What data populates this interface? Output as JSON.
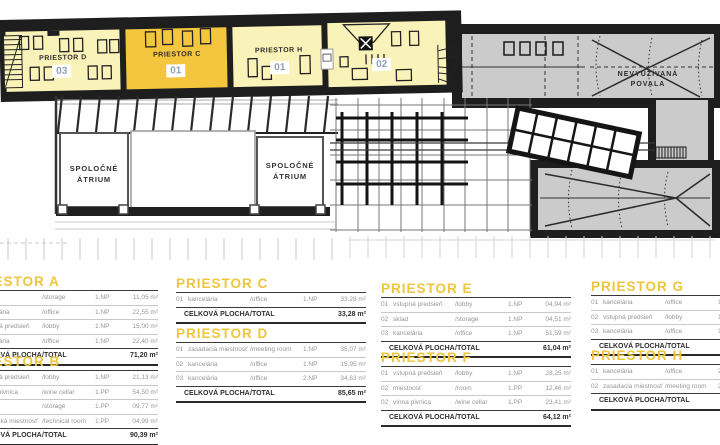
{
  "plan": {
    "rooms": [
      {
        "label": "PRIESTOR D",
        "badge": "03"
      },
      {
        "label": "PRIESTOR C",
        "badge": "01"
      },
      {
        "label": "PRIESTOR H",
        "badge": "01"
      },
      {
        "label": "",
        "badge": "02"
      }
    ],
    "attic": {
      "line1": "NEVYUŽÍVANÁ",
      "line2": "POVALA"
    },
    "atrium": {
      "line1": "SPOLOČNÉ",
      "line2": "ÁTRIUM"
    }
  },
  "colors": {
    "accent_gold": "#F3C63E",
    "room_pale": "#FAF3B9",
    "attic_gray": "#CBCBCB",
    "wall_black": "#1E1E1E",
    "badge_text": "#8FA0B5",
    "table_title": "#EFC53C"
  },
  "tables": [
    {
      "title": "PRIESTOR A",
      "rows": [
        {
          "n": "01",
          "sk": "sklad",
          "en": "/storage",
          "fl": "1.NP",
          "ar": "11,05 m²"
        },
        {
          "n": "02",
          "sk": "kancelária",
          "en": "/office",
          "fl": "1.NP",
          "ar": "22,55 m²"
        },
        {
          "n": "03",
          "sk": "vstupná predsieň",
          "en": "/lobby",
          "fl": "1.NP",
          "ar": "15,00 m²"
        },
        {
          "n": "04",
          "sk": "kancelária",
          "en": "/office",
          "fl": "1.NP",
          "ar": "22,40 m²"
        }
      ],
      "total": {
        "sk": "CELKOVÁ PLOCHA",
        "en": "/TOTAL",
        "ar": "71,20 m²"
      }
    },
    {
      "title": "PRIESTOR B",
      "rows": [
        {
          "n": "01",
          "sk": "vstupná predsieň",
          "en": "/lobby",
          "fl": "1.NP",
          "ar": "21,13 m²"
        },
        {
          "n": "02",
          "sk": "vínna pivnica",
          "en": "/wine cellar",
          "fl": "1.PP",
          "ar": "54,50 m²"
        },
        {
          "n": "03",
          "sk": "sklad",
          "en": "/storage",
          "fl": "1.PP",
          "ar": "09,77 m²"
        },
        {
          "n": "04",
          "sk": "technická miestnosť",
          "en": "/technical room",
          "fl": "1.PP",
          "ar": "04,99 m²"
        }
      ],
      "total": {
        "sk": "CELKOVÁ PLOCHA",
        "en": "/TOTAL",
        "ar": "90,39 m²"
      }
    },
    {
      "title": "PRIESTOR C",
      "rows": [
        {
          "n": "01",
          "sk": "kancelária",
          "en": "/office",
          "fl": "1.NP",
          "ar": "33,28 m²"
        }
      ],
      "total": {
        "sk": "CELKOVÁ PLOCHA",
        "en": "/TOTAL",
        "ar": "33,28 m²"
      }
    },
    {
      "title": "PRIESTOR D",
      "rows": [
        {
          "n": "01",
          "sk": "zasadacia miestnosť",
          "en": "/meeting room",
          "fl": "1.NP",
          "ar": "35,07 m²"
        },
        {
          "n": "02",
          "sk": "kancelária",
          "en": "/office",
          "fl": "1.NP",
          "ar": "15,95 m²"
        },
        {
          "n": "03",
          "sk": "kancelária",
          "en": "/office",
          "fl": "2.NP",
          "ar": "34,63 m²"
        }
      ],
      "total": {
        "sk": "CELKOVÁ PLOCHA",
        "en": "/TOTAL",
        "ar": "85,65 m²"
      }
    },
    {
      "title": "PRIESTOR E",
      "rows": [
        {
          "n": "01",
          "sk": "vstupná predsieň",
          "en": "/lobby",
          "fl": "1.NP",
          "ar": "04,94 m²"
        },
        {
          "n": "02",
          "sk": "sklad",
          "en": "/storage",
          "fl": "1.NP",
          "ar": "04,51 m²"
        },
        {
          "n": "03",
          "sk": "kancelária",
          "en": "/office",
          "fl": "1.NP",
          "ar": "51,59 m²"
        }
      ],
      "total": {
        "sk": "CELKOVÁ PLOCHA",
        "en": "/TOTAL",
        "ar": "61,04 m²"
      }
    },
    {
      "title": "PRIESTOR F",
      "rows": [
        {
          "n": "01",
          "sk": "vstupná predsieň",
          "en": "/lobby",
          "fl": "1.NP",
          "ar": "28,25 m²"
        },
        {
          "n": "02",
          "sk": "miestnosť",
          "en": "/room",
          "fl": "1.PP",
          "ar": "12,46 m²"
        },
        {
          "n": "02",
          "sk": "vínna pivnica",
          "en": "/wine cellar",
          "fl": "1.PP",
          "ar": "23,41 m²"
        }
      ],
      "total": {
        "sk": "CELKOVÁ PLOCHA",
        "en": "/TOTAL",
        "ar": "64,12 m²"
      }
    },
    {
      "title": "PRIESTOR G",
      "rows": [
        {
          "n": "01",
          "sk": "kancelária",
          "en": "/office",
          "fl": "1.NP",
          "ar": ""
        },
        {
          "n": "02",
          "sk": "vstupná predsieň",
          "en": "/lobby",
          "fl": "1.NP",
          "ar": ""
        },
        {
          "n": "03",
          "sk": "kancelária",
          "en": "/office",
          "fl": "1.NP",
          "ar": ""
        }
      ],
      "total": {
        "sk": "CELKOVÁ PLOCHA",
        "en": "/TOTAL",
        "ar": ""
      }
    },
    {
      "title": "PRIESTOR H",
      "rows": [
        {
          "n": "01",
          "sk": "kancelária",
          "en": "/office",
          "fl": "2.NP",
          "ar": ""
        },
        {
          "n": "02",
          "sk": "zasadacia miestnosť",
          "en": "/meeting room",
          "fl": "2.NP",
          "ar": ""
        }
      ],
      "total": {
        "sk": "CELKOVÁ PLOCHA",
        "en": "/TOTAL",
        "ar": ""
      }
    }
  ]
}
